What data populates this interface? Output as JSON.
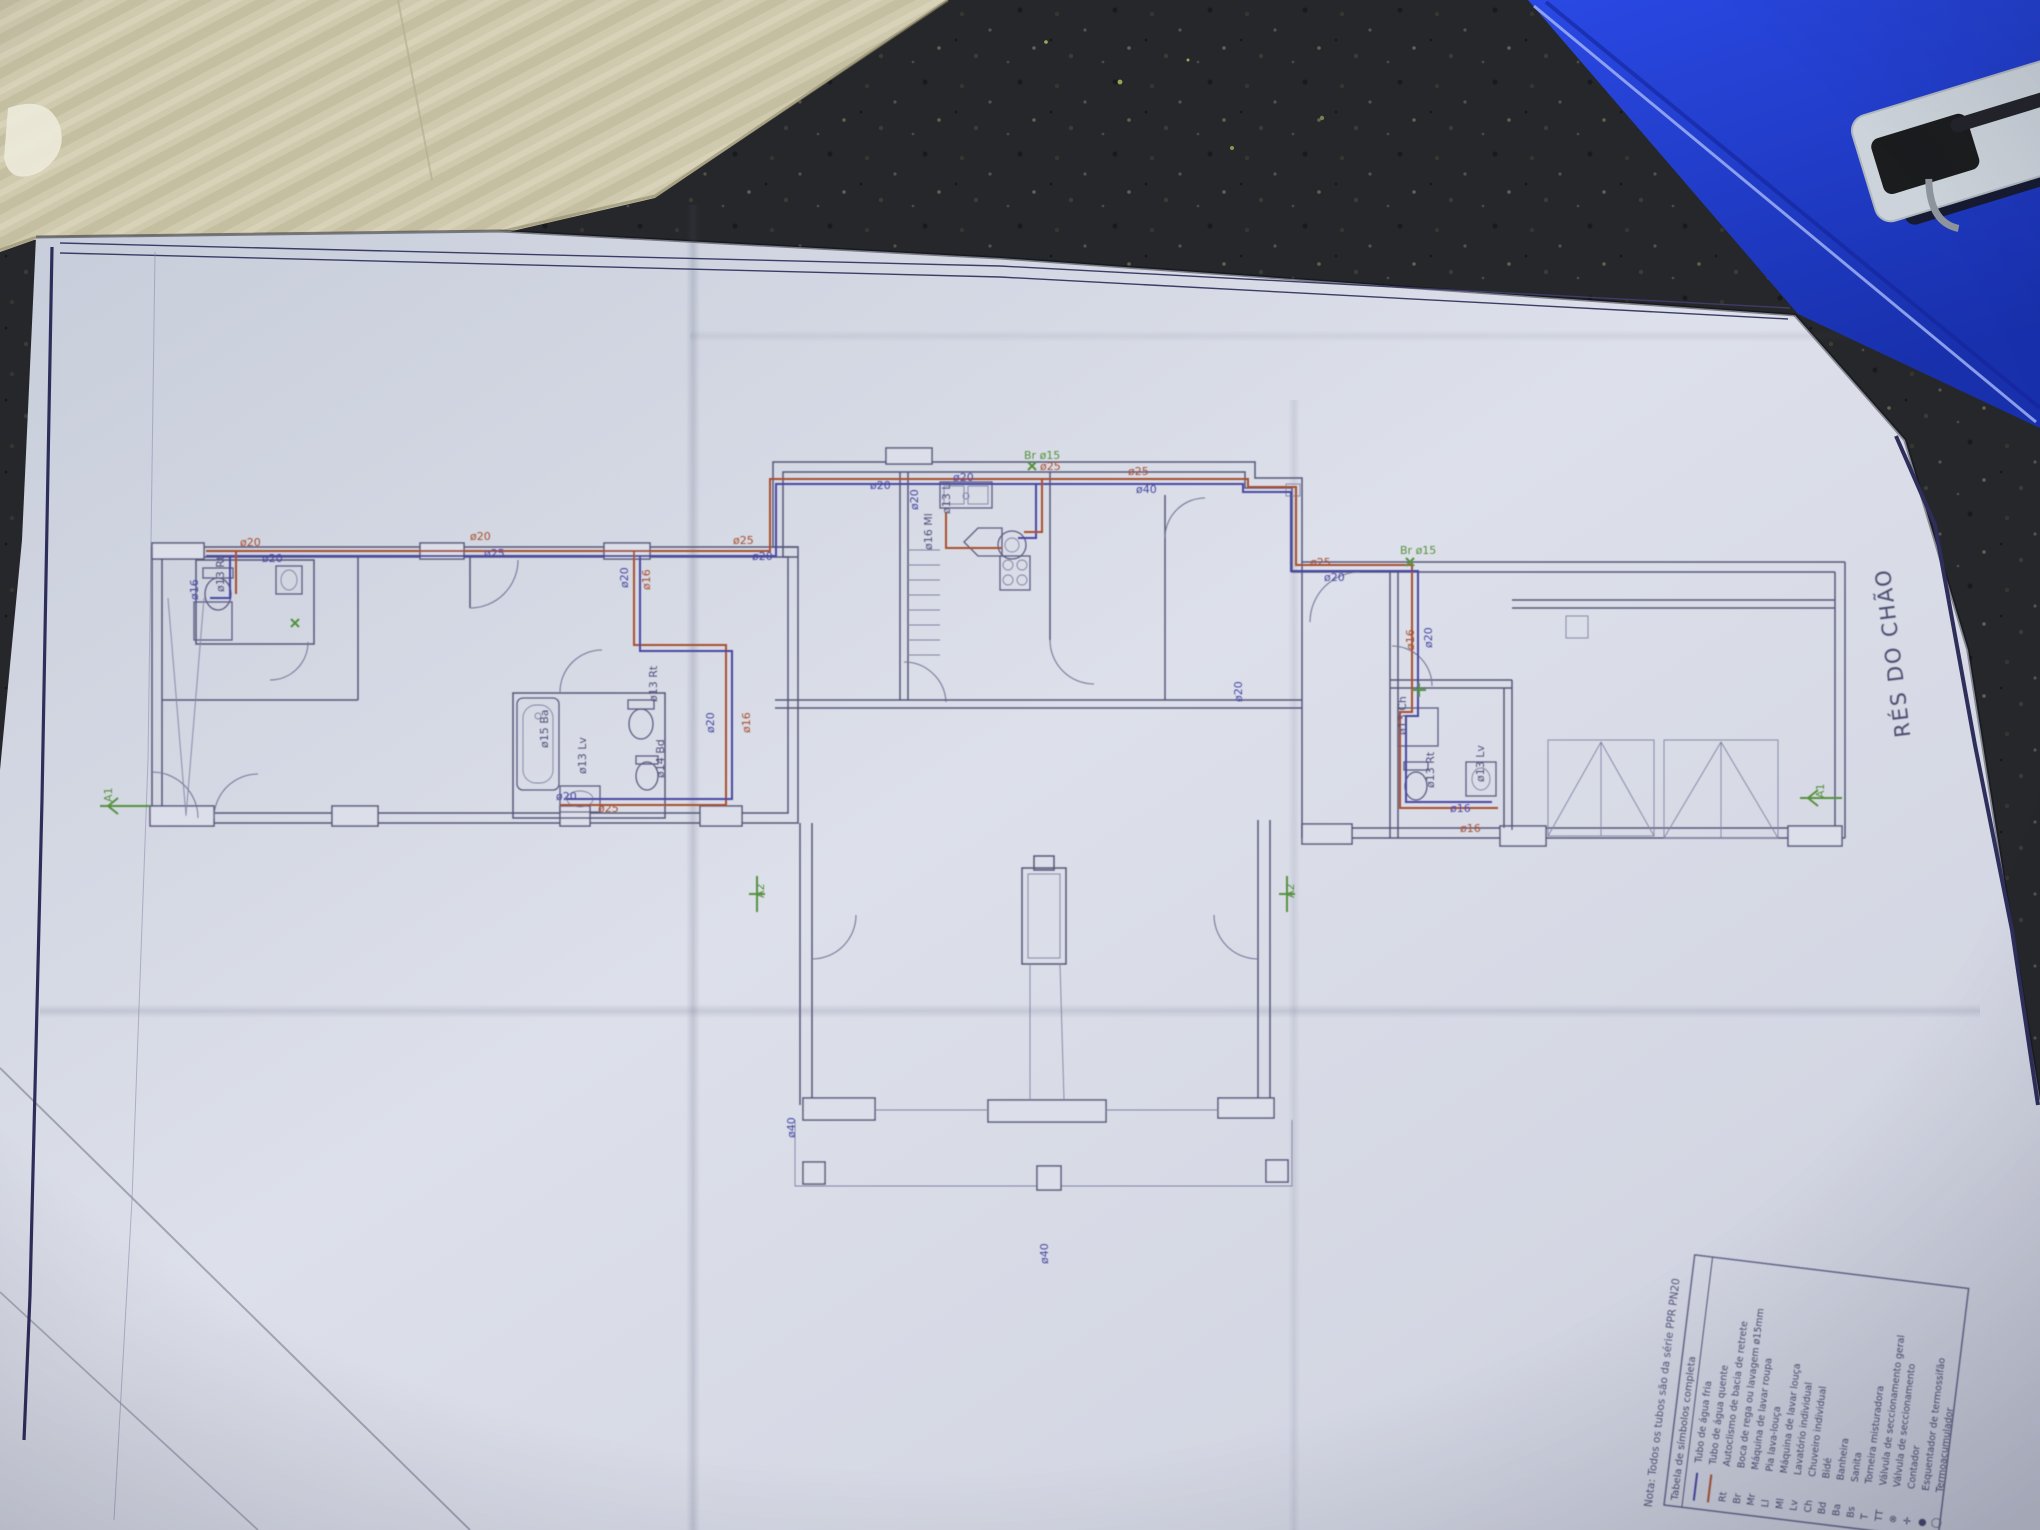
{
  "plan": {
    "title_vertical": "RÉS DO CHÃO",
    "note": "Nota:  Todos os tubos são da série PPR PN20",
    "pipe_labels": [
      {
        "t": "ø20",
        "x": 240,
        "y": 546,
        "r": 0,
        "c": "hot"
      },
      {
        "t": "ø20",
        "x": 262,
        "y": 562,
        "r": 0,
        "c": "cold"
      },
      {
        "t": "ø20",
        "x": 470,
        "y": 540,
        "r": 0,
        "c": "hot"
      },
      {
        "t": "ø25",
        "x": 484,
        "y": 557,
        "r": 0,
        "c": "cold"
      },
      {
        "t": "ø25",
        "x": 733,
        "y": 544,
        "r": 0,
        "c": "hot"
      },
      {
        "t": "ø20",
        "x": 752,
        "y": 560,
        "r": 0,
        "c": "cold"
      },
      {
        "t": "ø20",
        "x": 870,
        "y": 489,
        "r": 0,
        "c": "cold"
      },
      {
        "t": "ø20",
        "x": 953,
        "y": 481,
        "r": 0,
        "c": "cold"
      },
      {
        "t": "ø25",
        "x": 1040,
        "y": 470,
        "r": 0,
        "c": "hot"
      },
      {
        "t": "Br ø15",
        "x": 1024,
        "y": 459,
        "r": 0,
        "c": "green"
      },
      {
        "t": "ø25",
        "x": 1128,
        "y": 475,
        "r": 0,
        "c": "hot"
      },
      {
        "t": "ø40",
        "x": 1136,
        "y": 493,
        "r": 0,
        "c": "cold"
      },
      {
        "t": "ø25",
        "x": 1310,
        "y": 566,
        "r": 0,
        "c": "hot"
      },
      {
        "t": "ø20",
        "x": 1324,
        "y": 581,
        "r": 0,
        "c": "cold"
      },
      {
        "t": "Br ø15",
        "x": 1400,
        "y": 554,
        "r": 0,
        "c": "green"
      },
      {
        "t": "ø20",
        "x": 628,
        "y": 588,
        "r": -90,
        "c": "cold"
      },
      {
        "t": "ø16",
        "x": 650,
        "y": 590,
        "r": -90,
        "c": "hot"
      },
      {
        "t": "ø20",
        "x": 714,
        "y": 733,
        "r": -90,
        "c": "cold"
      },
      {
        "t": "ø16",
        "x": 750,
        "y": 733,
        "r": -90,
        "c": "hot"
      },
      {
        "t": "ø20",
        "x": 1432,
        "y": 648,
        "r": -90,
        "c": "cold"
      },
      {
        "t": "ø16",
        "x": 1414,
        "y": 650,
        "r": -90,
        "c": "hot"
      },
      {
        "t": "ø16",
        "x": 198,
        "y": 600,
        "r": -90,
        "c": "cold"
      },
      {
        "t": "ø20",
        "x": 918,
        "y": 510,
        "r": -90,
        "c": "cold"
      },
      {
        "t": "ø13 Rt",
        "x": 224,
        "y": 592,
        "r": -90,
        "c": "ink"
      },
      {
        "t": "ø13 Rt",
        "x": 657,
        "y": 702,
        "r": -90,
        "c": "ink"
      },
      {
        "t": "ø15 Ba",
        "x": 548,
        "y": 748,
        "r": -90,
        "c": "ink"
      },
      {
        "t": "ø14 Bd",
        "x": 664,
        "y": 778,
        "r": -90,
        "c": "ink"
      },
      {
        "t": "ø13 Lv",
        "x": 586,
        "y": 774,
        "r": -90,
        "c": "ink"
      },
      {
        "t": "ø13 Ll",
        "x": 950,
        "y": 514,
        "r": -90,
        "c": "ink"
      },
      {
        "t": "ø16 Ml",
        "x": 932,
        "y": 550,
        "r": -90,
        "c": "ink"
      },
      {
        "t": "ø13 Rt",
        "x": 1434,
        "y": 788,
        "r": -90,
        "c": "ink"
      },
      {
        "t": "ø13 Lv",
        "x": 1484,
        "y": 782,
        "r": -90,
        "c": "ink"
      },
      {
        "t": "ø13 Ch",
        "x": 1406,
        "y": 735,
        "r": -90,
        "c": "ink"
      },
      {
        "t": "A2",
        "x": 764,
        "y": 898,
        "r": -90,
        "c": "green"
      },
      {
        "t": "A2",
        "x": 1294,
        "y": 898,
        "r": -90,
        "c": "green"
      },
      {
        "t": "A1",
        "x": 112,
        "y": 802,
        "r": -90,
        "c": "green"
      },
      {
        "t": "A1",
        "x": 1824,
        "y": 798,
        "r": -90,
        "c": "green"
      },
      {
        "t": "ø40",
        "x": 795,
        "y": 1138,
        "r": -90,
        "c": "cold"
      },
      {
        "t": "ø40",
        "x": 1048,
        "y": 1264,
        "r": -90,
        "c": "cold"
      },
      {
        "t": "ø20",
        "x": 1242,
        "y": 702,
        "r": -90,
        "c": "cold"
      },
      {
        "t": "ø25",
        "x": 598,
        "y": 812,
        "r": 0,
        "c": "hot"
      },
      {
        "t": "ø20",
        "x": 556,
        "y": 800,
        "r": 0,
        "c": "cold"
      },
      {
        "t": "ø16",
        "x": 1450,
        "y": 812,
        "r": 0,
        "c": "cold"
      },
      {
        "t": "ø16",
        "x": 1460,
        "y": 832,
        "r": 0,
        "c": "hot"
      }
    ]
  },
  "legend": {
    "header": "Tabela de símbolos completa",
    "rows": [
      {
        "symbol": "",
        "line": "#4747a3",
        "label": "Tubo de água fria"
      },
      {
        "symbol": "",
        "line": "#a8502e",
        "label": "Tubo de água quente"
      },
      {
        "symbol": "Rt",
        "label": "Autoclismo de bacia de retrete"
      },
      {
        "symbol": "Br",
        "label": "Boca de rega ou lavagem ø15mm"
      },
      {
        "symbol": "Mr",
        "label": "Máquina de lavar roupa"
      },
      {
        "symbol": "Ll",
        "label": "Pia lava-louça"
      },
      {
        "symbol": "Ml",
        "label": "Máquina de lavar louça"
      },
      {
        "symbol": "Lv",
        "label": "Lavatório individual"
      },
      {
        "symbol": "Ch",
        "label": "Chuveiro individual"
      },
      {
        "symbol": "Bd",
        "label": "Bidé"
      },
      {
        "symbol": "Ba",
        "label": "Banheira"
      },
      {
        "symbol": "Bs",
        "label": "Sanita"
      },
      {
        "symbol": "T",
        "label": "Torneira misturadora"
      },
      {
        "symbol": "TT",
        "label": "Válvula de seccionamento geral"
      },
      {
        "symbol": "⊗",
        "label": "Válvula de seccionamento"
      },
      {
        "symbol": "✛",
        "label": "Contador"
      },
      {
        "symbol": "●",
        "label": "Esquentador de termossifão"
      },
      {
        "symbol": "◯",
        "label": "Termoacumulador"
      }
    ]
  },
  "colors": {
    "hot_pipe": "#a8502e",
    "cold_pipe": "#4747a3",
    "marker_green": "#55913d",
    "ink": "#50507a",
    "paper": "#d8dce7",
    "countertop": "#26272a",
    "folder_blue": "#2140d2",
    "cardboard": "#cfc9ae"
  }
}
